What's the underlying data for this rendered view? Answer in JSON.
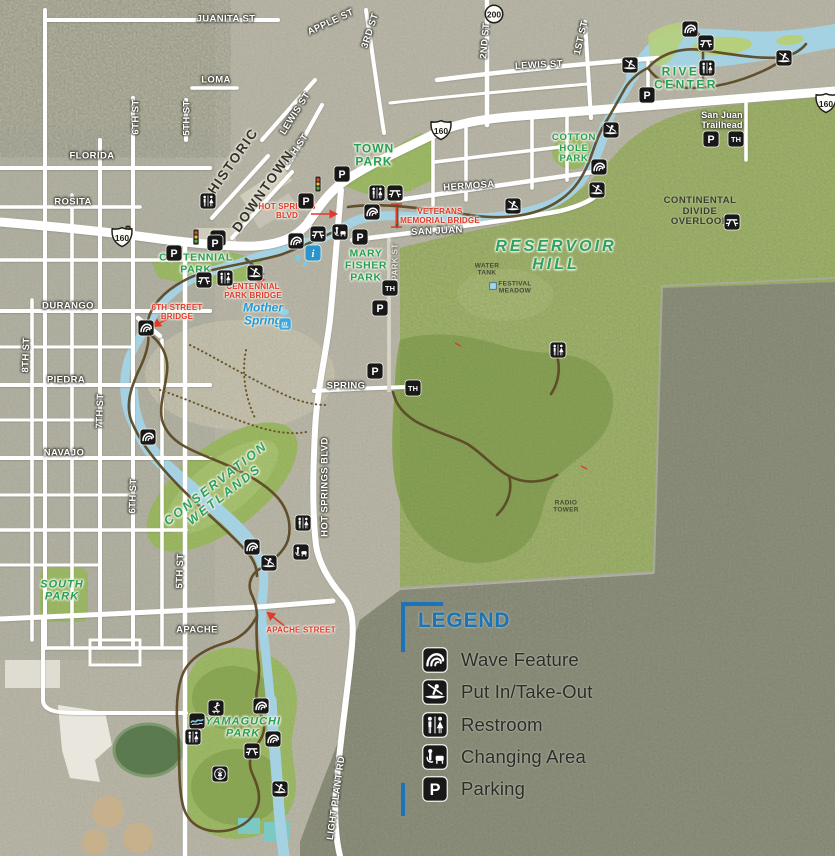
{
  "legend": {
    "title": "LEGEND",
    "items": [
      {
        "icon": "wave-feature",
        "label": "Wave Feature"
      },
      {
        "icon": "put-in-take-out",
        "label": "Put In/Take-Out"
      },
      {
        "icon": "restroom",
        "label": "Restroom"
      },
      {
        "icon": "changing-area",
        "label": "Changing Area"
      },
      {
        "icon": "parking",
        "label": "Parking"
      }
    ]
  },
  "colors": {
    "legend_blue": "#1b74b8",
    "park_label_green": "#27a055",
    "callout_red": "#e2392c",
    "river_blue": "#a5d2e2",
    "park_green": "#9dbb63",
    "trail_brown": "#5d4a26",
    "icon_black": "#181818",
    "info_blue": "#2d95cb"
  },
  "map": {
    "highway_shields": [
      {
        "type": "us-route",
        "number": "160",
        "x": 122,
        "y": 237
      },
      {
        "type": "us-route",
        "number": "160",
        "x": 441,
        "y": 130
      },
      {
        "type": "us-route",
        "number": "160",
        "x": 826,
        "y": 103
      },
      {
        "type": "state-route",
        "number": "200",
        "x": 494,
        "y": 14
      }
    ],
    "labels": [
      {
        "text": "JUANITA ST",
        "cls": "st",
        "x": 226,
        "y": 20
      },
      {
        "text": "APPLE ST",
        "cls": "st",
        "x": 331,
        "y": 23,
        "rot": -25
      },
      {
        "text": "3RD ST",
        "cls": "st",
        "x": 371,
        "y": 31,
        "rot": -72
      },
      {
        "text": "LOMA",
        "cls": "st",
        "x": 216,
        "y": 81
      },
      {
        "text": "LEWIS ST",
        "cls": "st",
        "x": 296,
        "y": 114,
        "rot": -58
      },
      {
        "text": "5TH ST",
        "cls": "st",
        "x": 188,
        "y": 118,
        "rot": -90
      },
      {
        "text": "6TH ST",
        "cls": "st",
        "x": 137,
        "y": 117,
        "rot": -90
      },
      {
        "text": "FLORIDA",
        "cls": "st",
        "x": 92,
        "y": 157
      },
      {
        "text": "2ND ST",
        "cls": "st",
        "x": 486,
        "y": 41,
        "rot": -85
      },
      {
        "text": "1ST ST",
        "cls": "st",
        "x": 582,
        "y": 38,
        "rot": -77
      },
      {
        "text": "LEWIS ST",
        "cls": "st",
        "x": 539,
        "y": 66,
        "rot": -3
      },
      {
        "text": "ROSITA",
        "cls": "st",
        "x": 73,
        "y": 203
      },
      {
        "text": "4TH ST",
        "cls": "st",
        "x": 297,
        "y": 150,
        "rot": -55
      },
      {
        "text": "HERMOSA",
        "cls": "st",
        "x": 469,
        "y": 187,
        "rot": -4
      },
      {
        "text": "SAN JUAN",
        "cls": "st",
        "x": 437,
        "y": 232,
        "rot": -3
      },
      {
        "text": "DURANGO",
        "cls": "st",
        "x": 68,
        "y": 307
      },
      {
        "text": "PIEDRA",
        "cls": "st",
        "x": 66,
        "y": 381
      },
      {
        "text": "7TH ST",
        "cls": "st",
        "x": 101,
        "y": 411,
        "rot": -88
      },
      {
        "text": "NAVAJO",
        "cls": "st",
        "x": 64,
        "y": 454
      },
      {
        "text": "6TH ST",
        "cls": "st",
        "x": 134,
        "y": 496,
        "rot": -88
      },
      {
        "text": "SPRING",
        "cls": "st",
        "x": 346,
        "y": 387
      },
      {
        "text": "5TH ST",
        "cls": "st",
        "x": 181,
        "y": 571,
        "rot": -88
      },
      {
        "text": "APACHE",
        "cls": "st",
        "x": 197,
        "y": 631
      },
      {
        "text": "HOT SPRINGS BLVD",
        "cls": "st",
        "x": 326,
        "y": 487,
        "rot": -90
      },
      {
        "text": "LIGHT PLANT RD",
        "cls": "st",
        "x": 337,
        "y": 798,
        "rot": -82
      },
      {
        "text": "8TH ST",
        "cls": "st",
        "x": 27,
        "y": 355,
        "rot": -88
      },
      {
        "text": "PARK ST",
        "cls": "st-sm",
        "x": 396,
        "y": 262,
        "rot": -90
      },
      {
        "text": "HISTORIC",
        "cls": "st-lg",
        "x": 233,
        "y": 161,
        "rot": -55
      },
      {
        "text": "DOWNTOWN",
        "cls": "st-lg",
        "x": 263,
        "y": 191,
        "rot": -55
      },
      {
        "text": "San Juan\nTrailhead",
        "cls": "wht",
        "x": 722,
        "y": 120
      },
      {
        "text": "TOWN\nPARK",
        "cls": "pk",
        "x": 374,
        "y": 156
      },
      {
        "text": "COTTON\nHOLE\nPARK",
        "cls": "pk-sm",
        "x": 574,
        "y": 149
      },
      {
        "text": "RIVER\nCENTER",
        "cls": "pk-sp",
        "x": 686,
        "y": 79
      },
      {
        "text": "CENTENNIAL\nPARK",
        "cls": "pk-md",
        "x": 196,
        "y": 264
      },
      {
        "text": "MARY\nFISHER\nPARK",
        "cls": "pk-md",
        "x": 366,
        "y": 266
      },
      {
        "text": "SOUTH\nPARK",
        "cls": "pk-it",
        "x": 62,
        "y": 591
      },
      {
        "text": "YAMAGUCHI\nPARK",
        "cls": "pk-it",
        "x": 243,
        "y": 728
      },
      {
        "text": "RESERVOIR\nHILL",
        "cls": "pk-big",
        "x": 556,
        "y": 256
      },
      {
        "text": "CONSERVATION\nWETLANDS",
        "cls": "pk-rot",
        "x": 220,
        "y": 489,
        "rot": -38
      },
      {
        "text": "CONTINENTAL\nDIVIDE\nOVERLOOK",
        "cls": "drk",
        "x": 700,
        "y": 212
      },
      {
        "text": "WATER\nTANK",
        "cls": "tin",
        "x": 487,
        "y": 270
      },
      {
        "text": "FESTIVAL\nMEADOW",
        "cls": "tin",
        "x": 515,
        "y": 288
      },
      {
        "text": "RADIO\nTOWER",
        "cls": "tin",
        "x": 566,
        "y": 507
      },
      {
        "text": "Mother\nSpring",
        "cls": "blu",
        "x": 263,
        "y": 315
      },
      {
        "text": "HOT SPRINGS\nBLVD",
        "cls": "red",
        "x": 287,
        "y": 211
      },
      {
        "text": "VETERANS\nMEMORIAL BRIDGE",
        "cls": "red",
        "x": 440,
        "y": 216
      },
      {
        "text": "CENTENNIAL\nPARK BRIDGE",
        "cls": "red",
        "x": 253,
        "y": 291
      },
      {
        "text": "6TH STREET\nBRIDGE",
        "cls": "red",
        "x": 177,
        "y": 312
      },
      {
        "text": "APACHE STREET",
        "cls": "red",
        "x": 301,
        "y": 630
      }
    ],
    "icons": [
      {
        "type": "wave-feature",
        "x": 690,
        "y": 29
      },
      {
        "type": "picnic",
        "x": 706,
        "y": 43
      },
      {
        "type": "restroom",
        "x": 707,
        "y": 68
      },
      {
        "type": "put-in-take-out",
        "x": 630,
        "y": 65
      },
      {
        "type": "put-in-take-out",
        "x": 784,
        "y": 58
      },
      {
        "type": "parking",
        "x": 647,
        "y": 95
      },
      {
        "type": "parking",
        "x": 711,
        "y": 139
      },
      {
        "type": "trailhead",
        "x": 736,
        "y": 139
      },
      {
        "type": "put-in-take-out",
        "x": 611,
        "y": 130
      },
      {
        "type": "wave-feature",
        "x": 599,
        "y": 167
      },
      {
        "type": "put-in-take-out",
        "x": 597,
        "y": 190
      },
      {
        "type": "put-in-take-out",
        "x": 513,
        "y": 206
      },
      {
        "type": "wave-feature",
        "x": 372,
        "y": 212
      },
      {
        "type": "restroom",
        "x": 377,
        "y": 193
      },
      {
        "type": "picnic",
        "x": 395,
        "y": 193
      },
      {
        "type": "parking",
        "x": 342,
        "y": 174
      },
      {
        "type": "parking",
        "x": 306,
        "y": 201
      },
      {
        "type": "restroom",
        "x": 208,
        "y": 201
      },
      {
        "type": "parking",
        "x": 218,
        "y": 238
      },
      {
        "type": "parking",
        "x": 174,
        "y": 253
      },
      {
        "type": "changing-area",
        "x": 340,
        "y": 232
      },
      {
        "type": "parking",
        "x": 360,
        "y": 237
      },
      {
        "type": "wave-feature",
        "x": 296,
        "y": 241
      },
      {
        "type": "picnic",
        "x": 318,
        "y": 234
      },
      {
        "type": "info",
        "x": 313,
        "y": 253
      },
      {
        "type": "parking",
        "x": 215,
        "y": 243
      },
      {
        "type": "picnic",
        "x": 204,
        "y": 280
      },
      {
        "type": "restroom",
        "x": 225,
        "y": 278
      },
      {
        "type": "put-in-take-out",
        "x": 255,
        "y": 273
      },
      {
        "type": "trailhead",
        "x": 390,
        "y": 288
      },
      {
        "type": "parking",
        "x": 380,
        "y": 308
      },
      {
        "type": "parking",
        "x": 375,
        "y": 371
      },
      {
        "type": "trailhead",
        "x": 413,
        "y": 388
      },
      {
        "type": "wave-feature",
        "x": 146,
        "y": 328
      },
      {
        "type": "wave-feature",
        "x": 148,
        "y": 437
      },
      {
        "type": "restroom",
        "x": 303,
        "y": 523
      },
      {
        "type": "changing-area",
        "x": 301,
        "y": 552
      },
      {
        "type": "wave-feature",
        "x": 252,
        "y": 547
      },
      {
        "type": "put-in-take-out",
        "x": 269,
        "y": 563
      },
      {
        "type": "picnic",
        "x": 732,
        "y": 222
      },
      {
        "type": "restroom",
        "x": 558,
        "y": 350
      },
      {
        "type": "wave-feature",
        "x": 261,
        "y": 706
      },
      {
        "type": "skate-park",
        "x": 216,
        "y": 708
      },
      {
        "type": "water-play",
        "x": 197,
        "y": 721
      },
      {
        "type": "restroom",
        "x": 193,
        "y": 737
      },
      {
        "type": "wave-feature",
        "x": 273,
        "y": 739
      },
      {
        "type": "picnic",
        "x": 252,
        "y": 751
      },
      {
        "type": "disc-golf",
        "x": 220,
        "y": 774
      },
      {
        "type": "put-in-take-out",
        "x": 280,
        "y": 789
      },
      {
        "type": "traffic-signal",
        "x": 128,
        "y": 233
      },
      {
        "type": "traffic-signal",
        "x": 196,
        "y": 237
      },
      {
        "type": "traffic-signal",
        "x": 318,
        "y": 184
      },
      {
        "type": "hot-spring",
        "x": 285,
        "y": 324
      },
      {
        "type": "water-tank",
        "x": 493,
        "y": 286
      }
    ]
  }
}
